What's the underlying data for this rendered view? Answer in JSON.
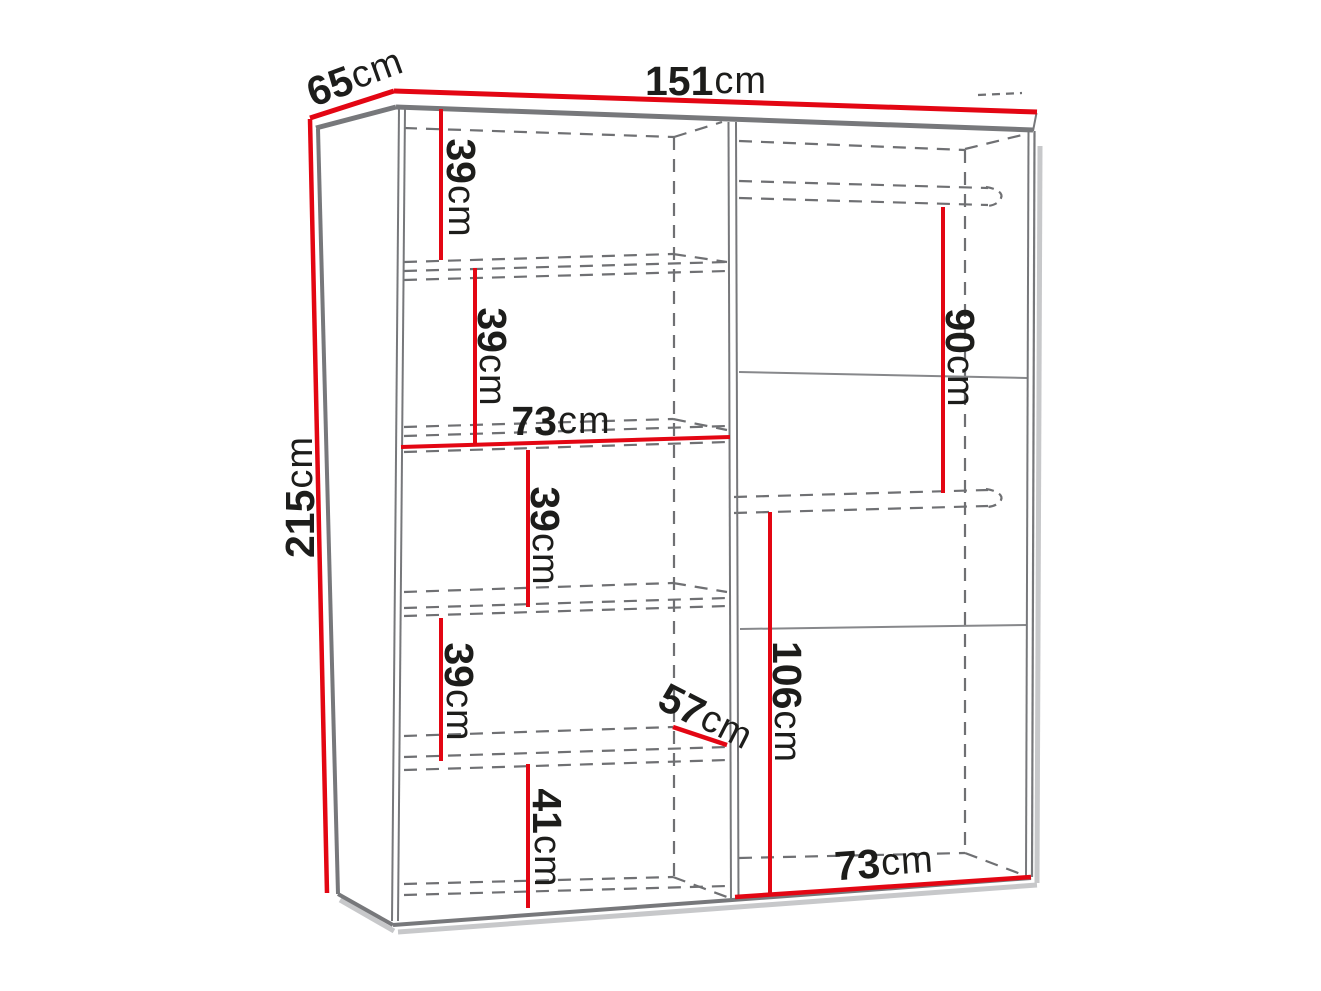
{
  "diagram": {
    "palette": {
      "dimension_red": "#e30613",
      "edge_gray": "#77787b",
      "dash_gray": "#6f7073",
      "shadow_gray": "#c7c8ca",
      "text_black": "#1d1d1b",
      "background": "#ffffff"
    },
    "labels": {
      "width_top": {
        "value": "151",
        "unit": "cm"
      },
      "depth_top": {
        "value": "65",
        "unit": "cm"
      },
      "height_left": {
        "value": "215",
        "unit": "cm"
      },
      "left_gap_1": {
        "value": "39",
        "unit": "cm"
      },
      "left_gap_2": {
        "value": "39",
        "unit": "cm"
      },
      "left_inner_width": {
        "value": "73",
        "unit": "cm"
      },
      "left_gap_3": {
        "value": "39",
        "unit": "cm"
      },
      "left_gap_4": {
        "value": "39",
        "unit": "cm"
      },
      "left_gap_5": {
        "value": "41",
        "unit": "cm"
      },
      "divider_depth": {
        "value": "57",
        "unit": "cm"
      },
      "right_gap_upper": {
        "value": "90",
        "unit": "cm"
      },
      "right_gap_lower": {
        "value": "106",
        "unit": "cm"
      },
      "right_inner_width": {
        "value": "73",
        "unit": "cm"
      }
    }
  }
}
